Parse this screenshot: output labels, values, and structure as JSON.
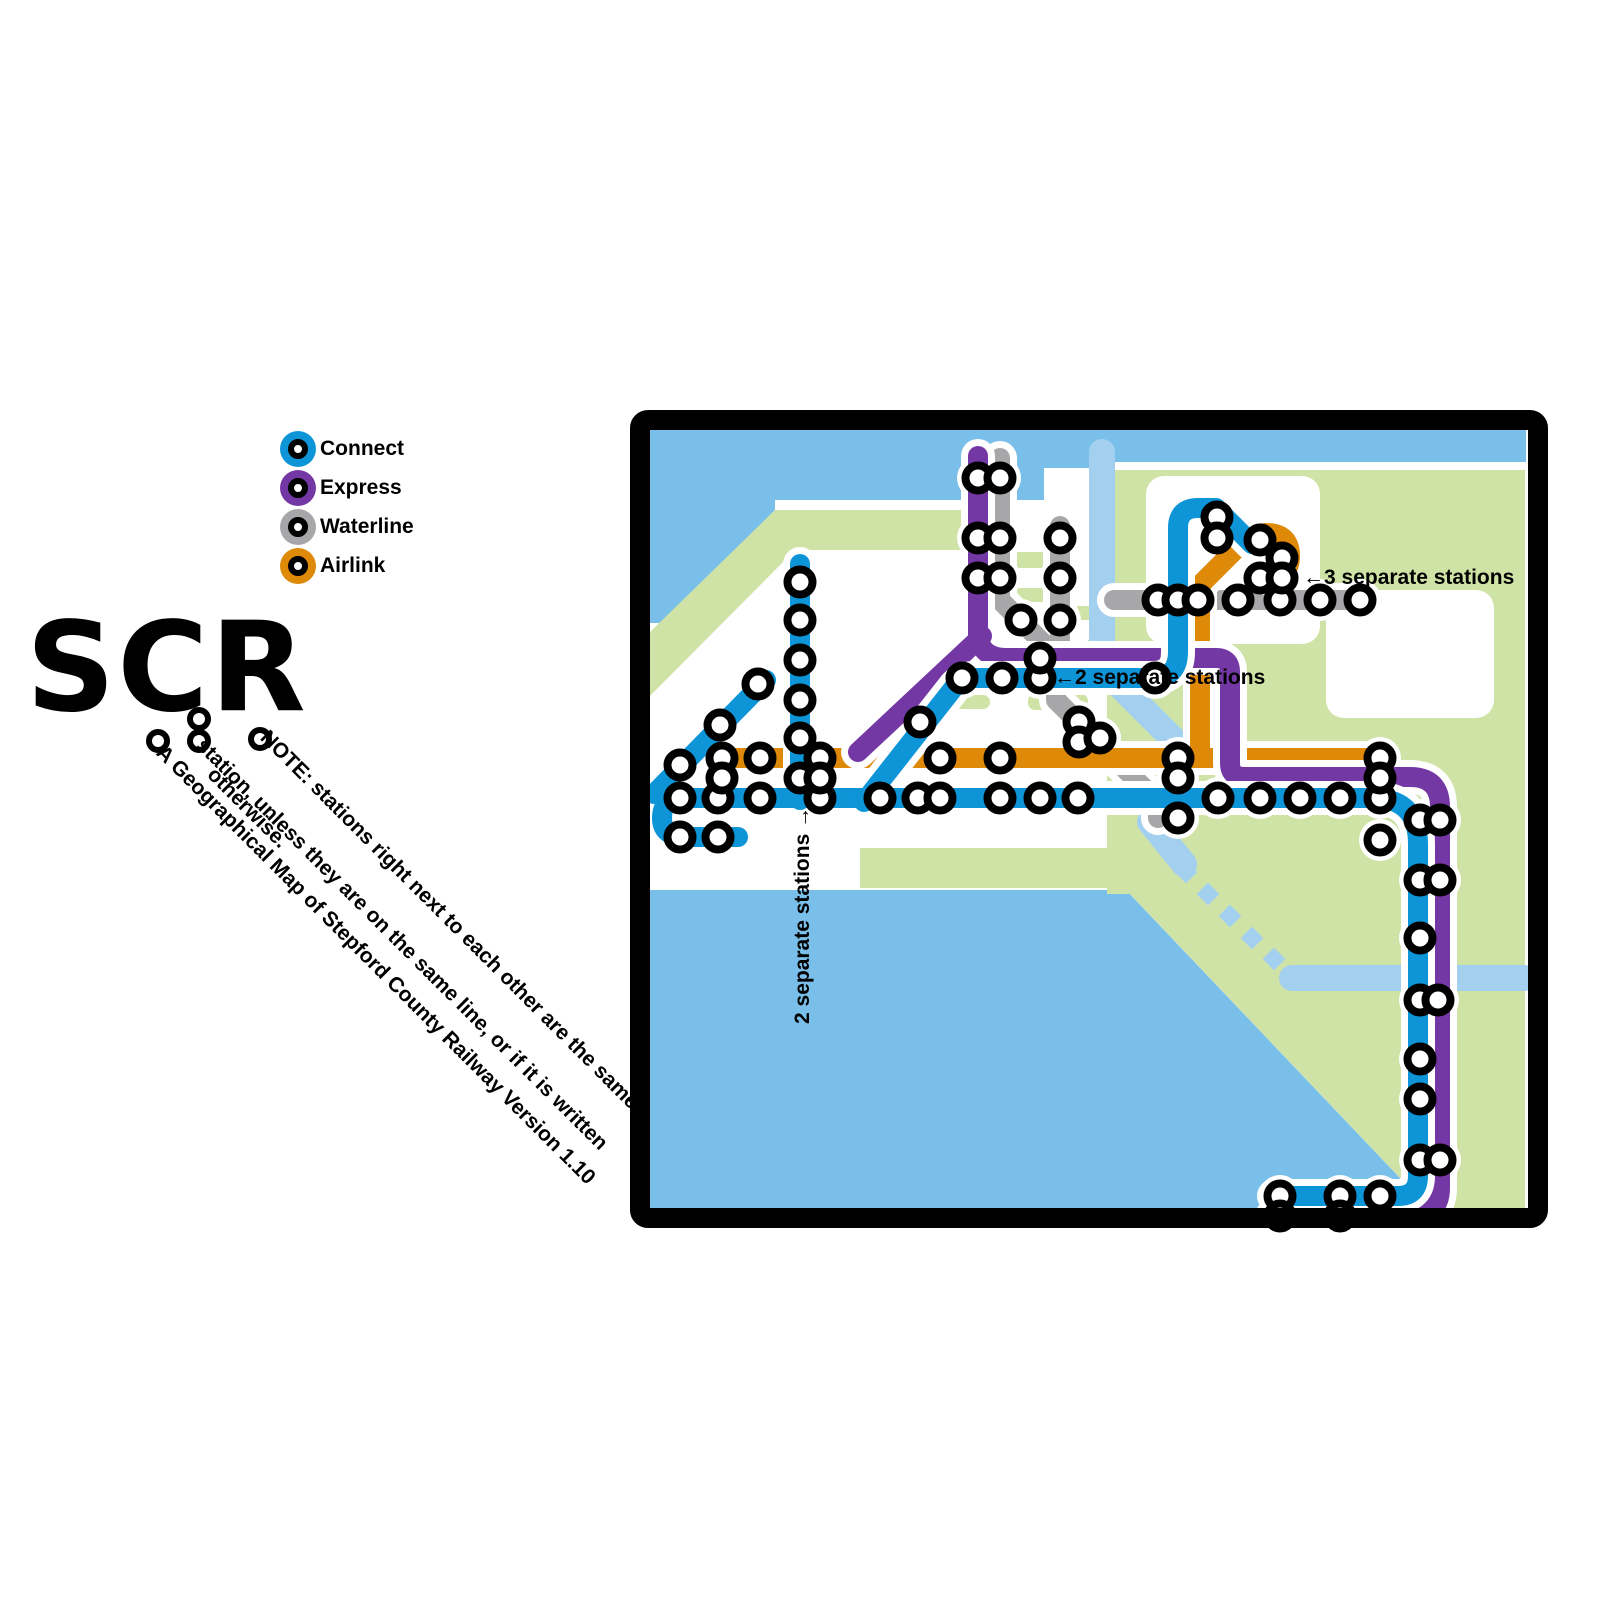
{
  "logo": {
    "text": "SCR",
    "circles": [
      [
        158,
        741
      ],
      [
        199,
        719
      ],
      [
        199,
        741
      ],
      [
        260,
        739
      ]
    ]
  },
  "titles": {
    "note_line1": "NOTE: stations right next to each other are the same",
    "note_line2": "station, unless they are on the same line, or if it is written",
    "note_line3": "otherwise.",
    "map_title": "A Geographical Map of Stepford County Railway Version 1.10"
  },
  "annotations": {
    "three_separate": "←3 separate stations",
    "two_separate_horizontal": "←2 separate stations",
    "two_separate_vertical": "2 separate stations →"
  },
  "legend": {
    "items": [
      {
        "label": "Connect",
        "color": "#0d95d8"
      },
      {
        "label": "Express",
        "color": "#7438a5"
      },
      {
        "label": "Waterline",
        "color": "#a7a7a9"
      },
      {
        "label": "Airlink",
        "color": "#df8908"
      }
    ]
  },
  "map": {
    "colors": {
      "sea": "#79bfe9",
      "land": "#cfe3a6",
      "river": "#a4d0f0",
      "frame": "#000000",
      "station_fill": "#ffffff",
      "station_ring": "#000000"
    },
    "frame": {
      "x": 640,
      "y": 420,
      "w": 898,
      "h": 798,
      "stroke": 20
    },
    "water": [
      "M650,430 L1526,430 L1526,462 L1110,462 L1110,468 L1044,468 L1044,500 L775,500 L775,510 L662,623 L650,623 Z",
      "M650,890 L1126,890 L1400,1178 L1400,1208 L650,1208 Z"
    ],
    "land": [
      "M1107,470 L1525,470 L1525,1208 L1404,1208 L1404,1182 L1130,894 L1107,894 Z",
      "M860,848 L1130,848 L1130,888 L860,888 Z",
      "M650,632 L775,510 L962,510 L962,550 L795,550 L650,696 Z"
    ],
    "land_pills": [
      [
        1002,
        552,
        50,
        16
      ],
      [
        1010,
        588,
        40,
        14
      ],
      [
        1062,
        606,
        78,
        14
      ],
      [
        1086,
        638,
        64,
        14
      ],
      [
        944,
        695,
        46,
        14
      ],
      [
        1028,
        694,
        60,
        16
      ]
    ],
    "land_circles": [
      [
        1396,
        815,
        13
      ]
    ],
    "white_patches": [
      [
        1146,
        476,
        174,
        168
      ],
      [
        1326,
        590,
        168,
        128
      ]
    ],
    "river": {
      "solid": [
        "M1102,452 L1102,640 Q1102,668 1120,686 L1180,746",
        "M1150,822 L1184,864",
        "M1292,978 L1524,978"
      ],
      "dashes": [
        [
          1186,
          872
        ],
        [
          1208,
          894
        ],
        [
          1230,
          916
        ],
        [
          1252,
          938
        ],
        [
          1274,
          959
        ]
      ]
    },
    "lines": [
      {
        "name": "Waterline",
        "color": "#a7a7a9",
        "paths": [
          "M1000,458 L1000,600 L1040,640 L1056,656 L1056,700 L1158,802 L1158,818",
          "M1060,526 L1060,640",
          "M1114,600 L1362,600"
        ]
      },
      {
        "name": "Airlink",
        "color": "#df8908",
        "paths": [
          "M731,758 L1374,758",
          "M1200,756 L1200,585 L1240,545 Q1252,533 1266,533 Q1290,533 1290,556 Q1290,578 1266,578"
        ]
      },
      {
        "name": "Express",
        "color": "#7438a5",
        "paths": [
          "M978,456 L978,636",
          "M982,636 L858,752",
          "M978,630 Q978,658 1006,658 L1216,658 Q1230,658 1230,672 L1230,763 Q1230,777 1244,777 L1410,777 Q1440,777 1440,807 L1440,1188 Q1440,1216 1410,1216 L1272,1216"
        ]
      },
      {
        "name": "Connect",
        "color": "#0d95d8",
        "paths": [
          "M738,837 L686,837 Q662,837 662,818 Q662,798 684,798 L1372,798 Q1418,798 1418,844 L1418,1176 Q1418,1196 1398,1196 L1274,1196",
          "M654,794 L766,680",
          "M800,564 L800,800",
          "M864,802 L952,690 Q960,678 974,678 L1152,678 Q1178,678 1178,652 L1178,528 Q1178,508 1198,508 L1216,508 L1252,544"
        ]
      }
    ],
    "stations": [
      [
        680,
        798
      ],
      [
        718,
        798
      ],
      [
        760,
        798
      ],
      [
        820,
        798
      ],
      [
        880,
        798
      ],
      [
        918,
        798
      ],
      [
        940,
        798
      ],
      [
        1000,
        798
      ],
      [
        1040,
        798
      ],
      [
        1078,
        798
      ],
      [
        1218,
        798
      ],
      [
        1260,
        798
      ],
      [
        1300,
        798
      ],
      [
        1340,
        798
      ],
      [
        1380,
        798
      ],
      [
        680,
        837
      ],
      [
        718,
        837
      ],
      [
        680,
        765
      ],
      [
        720,
        725
      ],
      [
        758,
        684
      ],
      [
        800,
        582
      ],
      [
        800,
        620
      ],
      [
        800,
        660
      ],
      [
        800,
        700
      ],
      [
        800,
        738
      ],
      [
        800,
        778
      ],
      [
        722,
        758
      ],
      [
        722,
        778
      ],
      [
        760,
        758
      ],
      [
        820,
        758
      ],
      [
        940,
        758
      ],
      [
        1000,
        758
      ],
      [
        820,
        778
      ],
      [
        920,
        722
      ],
      [
        962,
        678
      ],
      [
        1002,
        678
      ],
      [
        1040,
        678
      ],
      [
        1040,
        658
      ],
      [
        1155,
        678
      ],
      [
        978,
        478
      ],
      [
        1000,
        478
      ],
      [
        978,
        538
      ],
      [
        1000,
        538
      ],
      [
        978,
        578
      ],
      [
        1000,
        578
      ],
      [
        1021,
        620
      ],
      [
        1060,
        620
      ],
      [
        1060,
        538
      ],
      [
        1060,
        578
      ],
      [
        1079,
        722
      ],
      [
        1079,
        742
      ],
      [
        1100,
        738
      ],
      [
        1158,
        600
      ],
      [
        1178,
        600
      ],
      [
        1198,
        600
      ],
      [
        1238,
        600
      ],
      [
        1280,
        600
      ],
      [
        1320,
        600
      ],
      [
        1360,
        600
      ],
      [
        1217,
        517
      ],
      [
        1217,
        538
      ],
      [
        1260,
        540
      ],
      [
        1282,
        558
      ],
      [
        1260,
        578
      ],
      [
        1282,
        578
      ],
      [
        1178,
        758
      ],
      [
        1178,
        778
      ],
      [
        1178,
        818
      ],
      [
        1380,
        758
      ],
      [
        1380,
        778
      ],
      [
        1380,
        840
      ],
      [
        1420,
        820
      ],
      [
        1440,
        820
      ],
      [
        1420,
        880
      ],
      [
        1440,
        880
      ],
      [
        1420,
        938
      ],
      [
        1420,
        1000
      ],
      [
        1438,
        1000
      ],
      [
        1420,
        1059
      ],
      [
        1420,
        1099
      ],
      [
        1420,
        1160
      ],
      [
        1440,
        1160
      ],
      [
        1280,
        1196
      ],
      [
        1280,
        1216
      ],
      [
        1340,
        1196
      ],
      [
        1340,
        1216
      ],
      [
        1380,
        1196
      ]
    ],
    "style": {
      "line_width": 20,
      "casing_width": 34,
      "station_r": 12.5,
      "station_ring_w": 8,
      "halo_r": 21
    }
  }
}
